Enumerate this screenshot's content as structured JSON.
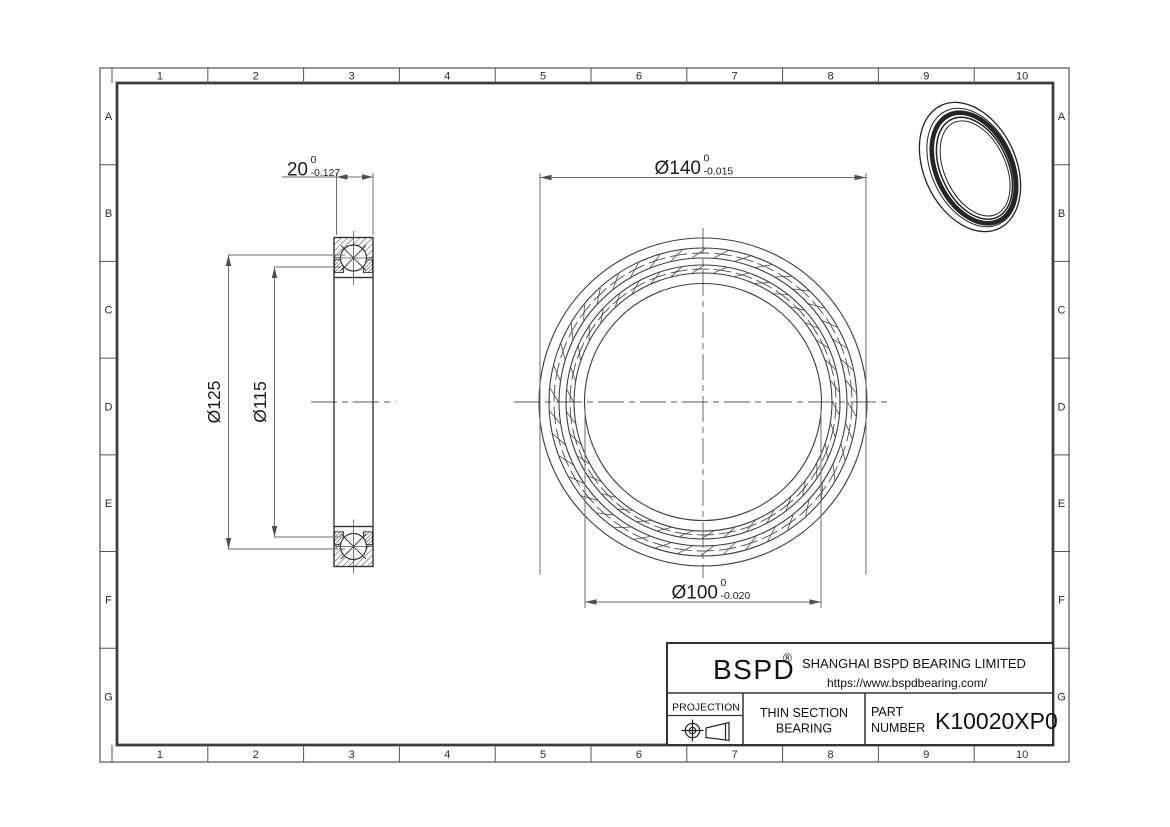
{
  "drawing": {
    "grid": {
      "columns": [
        "1",
        "2",
        "3",
        "4",
        "5",
        "6",
        "7",
        "8",
        "9",
        "10"
      ],
      "rows": [
        "A",
        "B",
        "C",
        "D",
        "E",
        "F",
        "G"
      ]
    },
    "dimensions": [
      {
        "id": "width",
        "text": "20",
        "tol_upper": "0",
        "tol_lower": "-0.127"
      },
      {
        "id": "outer-dia",
        "text": "Ø140",
        "tol_upper": "0",
        "tol_lower": "-0.015"
      },
      {
        "id": "bore-dia",
        "text": "Ø100",
        "tol_upper": "0",
        "tol_lower": "-0.020"
      },
      {
        "id": "outer-race",
        "text": "Ø125"
      },
      {
        "id": "inner-race",
        "text": "Ø115"
      }
    ],
    "title_block": {
      "brand": "BSPD",
      "registered": "®",
      "company": "SHANGHAI BSPD BEARING LIMITED",
      "website": "https://www.bspdbearing.com/",
      "projection_label": "PROJECTION",
      "product_line1": "THIN SECTION",
      "product_line2": "BEARING",
      "part_label_line1": "PART",
      "part_label_line2": "NUMBER",
      "part_number": "K10020XP0"
    }
  }
}
